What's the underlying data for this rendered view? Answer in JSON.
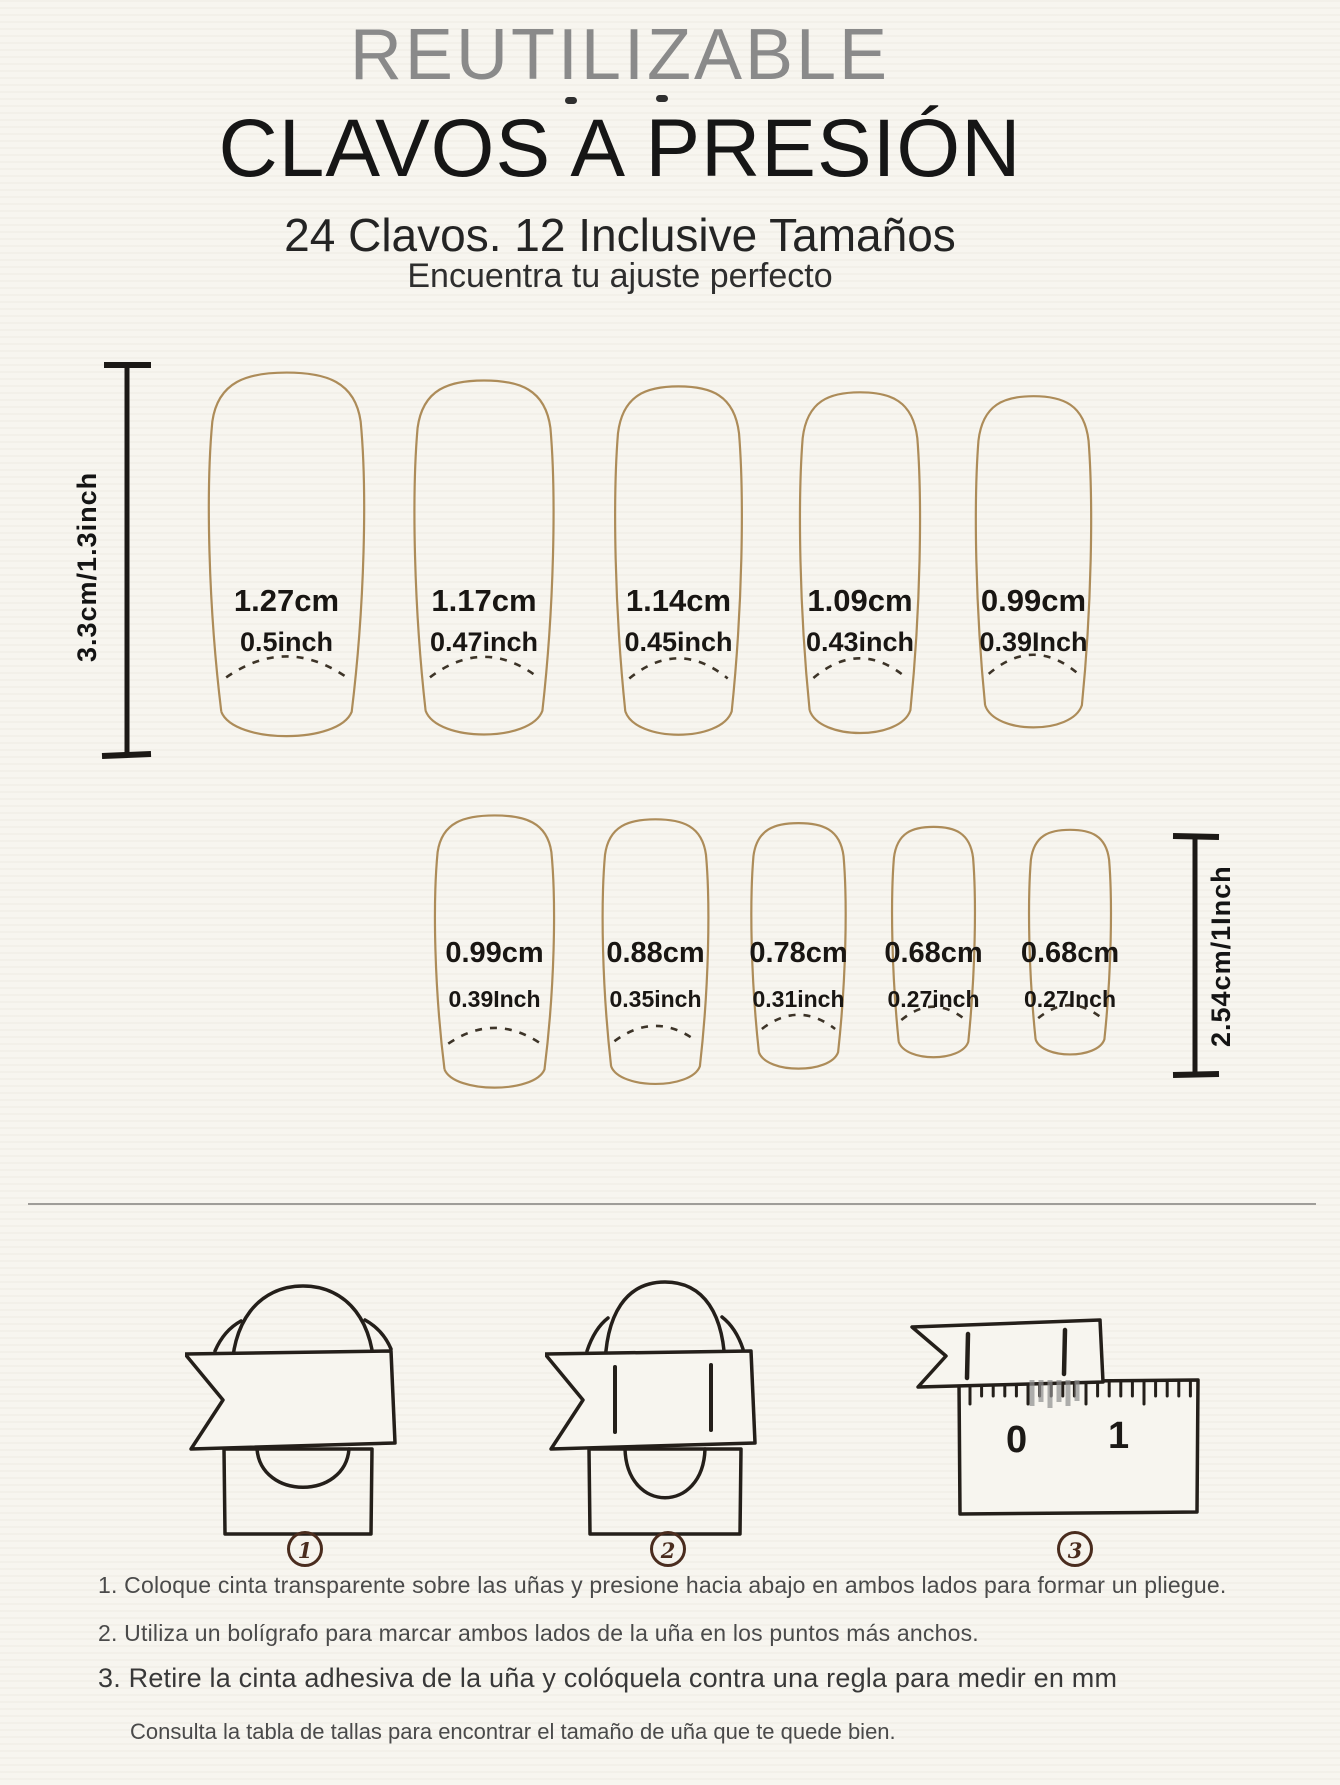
{
  "header": {
    "eyebrow": "REUTILIZABLE",
    "title": "CLAVOS A PRESIÓN",
    "subtitle": "24 Clavos. 12 Inclusive Tamaños",
    "tagline": "Encuentra tu ajuste perfecto"
  },
  "size_chart": {
    "rows": [
      {
        "ruler": {
          "label": "3.3cm/1.3inch",
          "side": "left"
        },
        "nails": [
          {
            "cm": "1.27cm",
            "inch": "0.5inch"
          },
          {
            "cm": "1.17cm",
            "inch": "0.47inch"
          },
          {
            "cm": "1.14cm",
            "inch": "0.45inch"
          },
          {
            "cm": "1.09cm",
            "inch": "0.43inch"
          },
          {
            "cm": "0.99cm",
            "inch": "0.39Inch"
          }
        ]
      },
      {
        "ruler": {
          "label": "2.54cm/1Inch",
          "side": "right"
        },
        "nails": [
          {
            "cm": "0.99cm",
            "inch": "0.39Inch"
          },
          {
            "cm": "0.88cm",
            "inch": "0.35inch"
          },
          {
            "cm": "0.78cm",
            "inch": "0.31inch"
          },
          {
            "cm": "0.68cm",
            "inch": "0.27inch"
          },
          {
            "cm": "0.68cm",
            "inch": "0.27Inch"
          }
        ]
      }
    ]
  },
  "steps": {
    "badges": [
      "1",
      "2",
      "3"
    ],
    "ruler_labels": {
      "zero": "0",
      "one": "1"
    }
  },
  "instructions": {
    "items": [
      "1. Coloque cinta transparente sobre las uñas y presione hacia abajo en ambos lados para formar un pliegue.",
      "2. Utiliza un bolígrafo para marcar ambos lados de la uña en los puntos más anchos.",
      "3. Retire la cinta adhesiva de la uña y colóquela contra una regla para medir en mm"
    ],
    "note": "Consulta la tabla de tallas para encontrar el tamaño de uña que te quede bien."
  },
  "colors": {
    "background": "#f7f5ef",
    "nail_outline": "#ad8c59",
    "smile_dash": "#3d3428",
    "line_art": "#241f1a",
    "badge": "#4a2c1e",
    "eyebrow_text": "#8a8a8a",
    "title_text": "#161616"
  }
}
